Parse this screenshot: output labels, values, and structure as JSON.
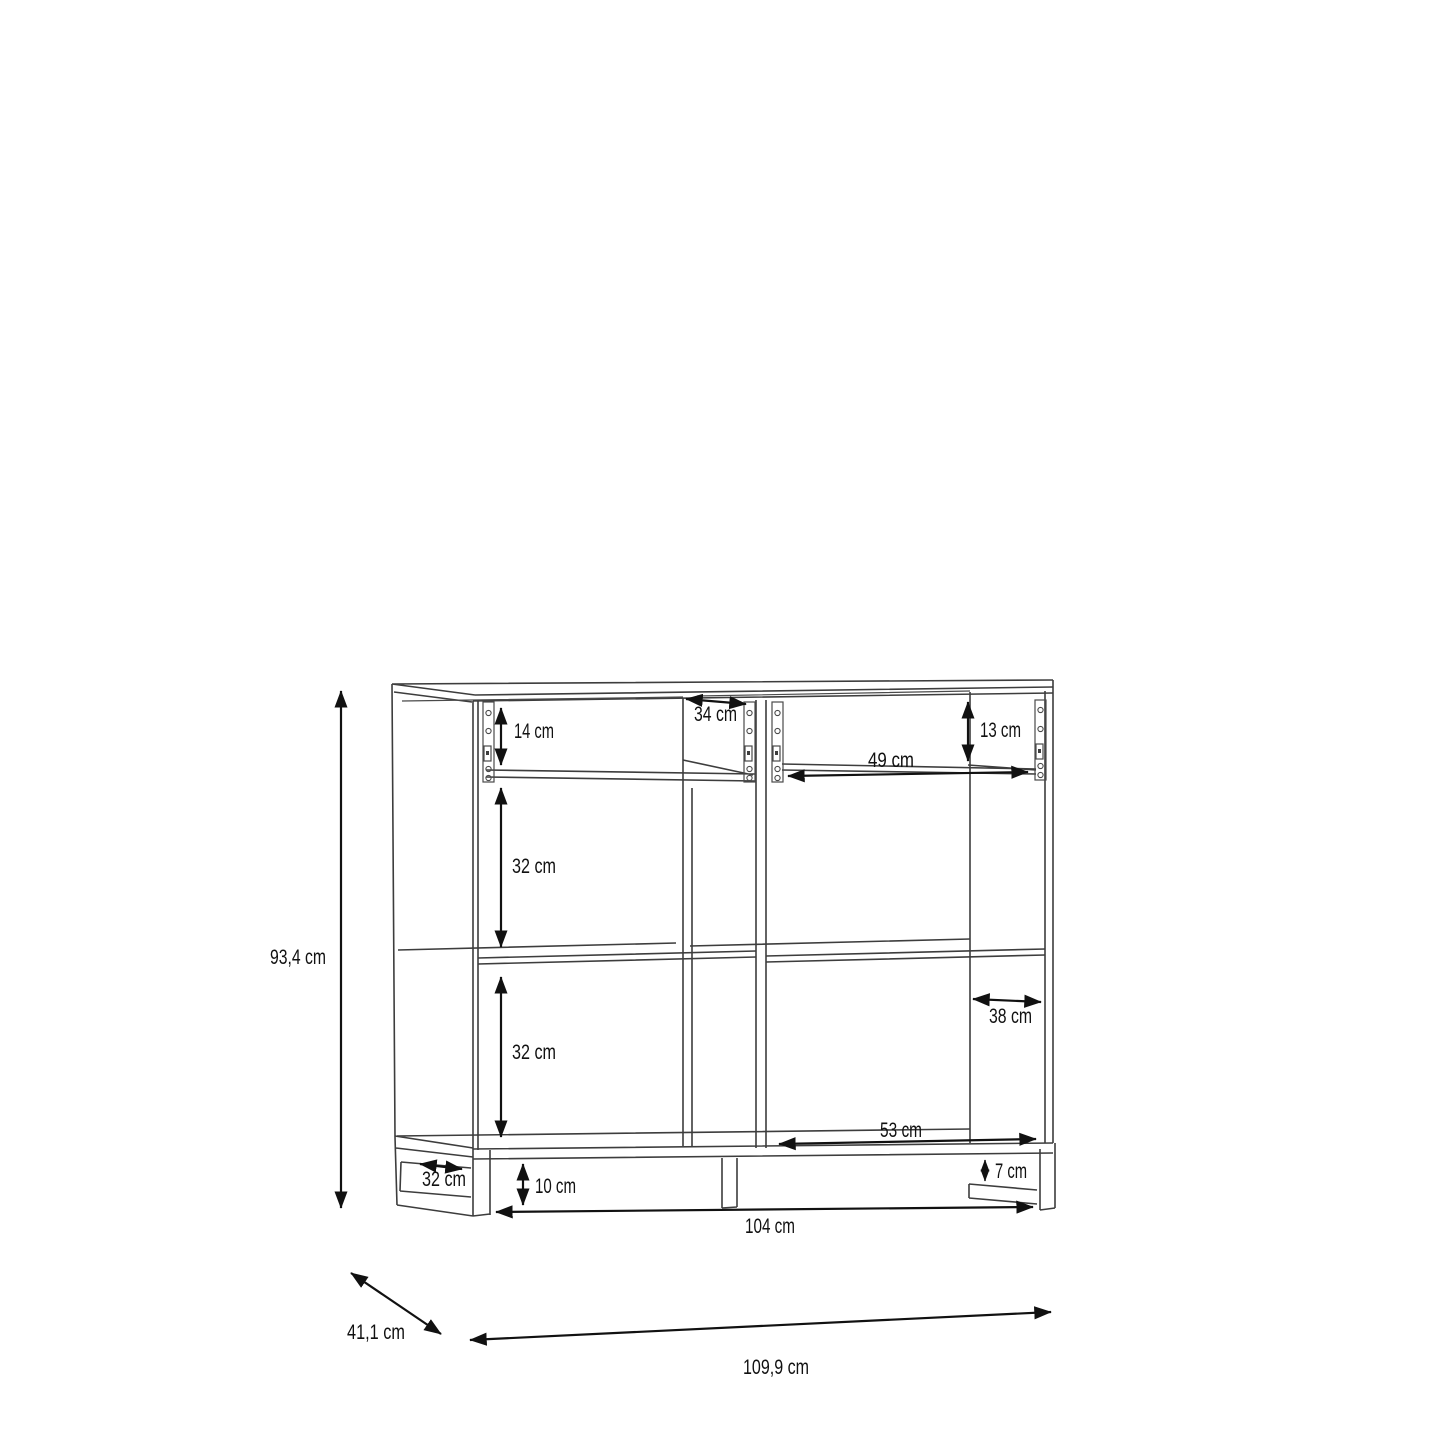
{
  "drawing_kind": "cabinet-dimension-diagram",
  "colors": {
    "background": "#ffffff",
    "structure_line": "#3d3d3d",
    "dimension_line": "#111111",
    "text": "#111111"
  },
  "dimensions": {
    "overall_height": "93,4 cm",
    "overall_depth": "41,1 cm",
    "overall_width": "109,9 cm",
    "left_drawer_height": "14 cm",
    "left_top_depth": "34 cm",
    "right_drawer_height": "13 cm",
    "right_drawer_width": "49 cm",
    "left_upper_section_height": "32 cm",
    "left_lower_section_height": "32 cm",
    "right_section_depth": "38 cm",
    "right_bottom_width": "53 cm",
    "left_leg_depth": "32 cm",
    "base_height": "10 cm",
    "right_leg_height": "7 cm",
    "base_width": "104 cm"
  }
}
